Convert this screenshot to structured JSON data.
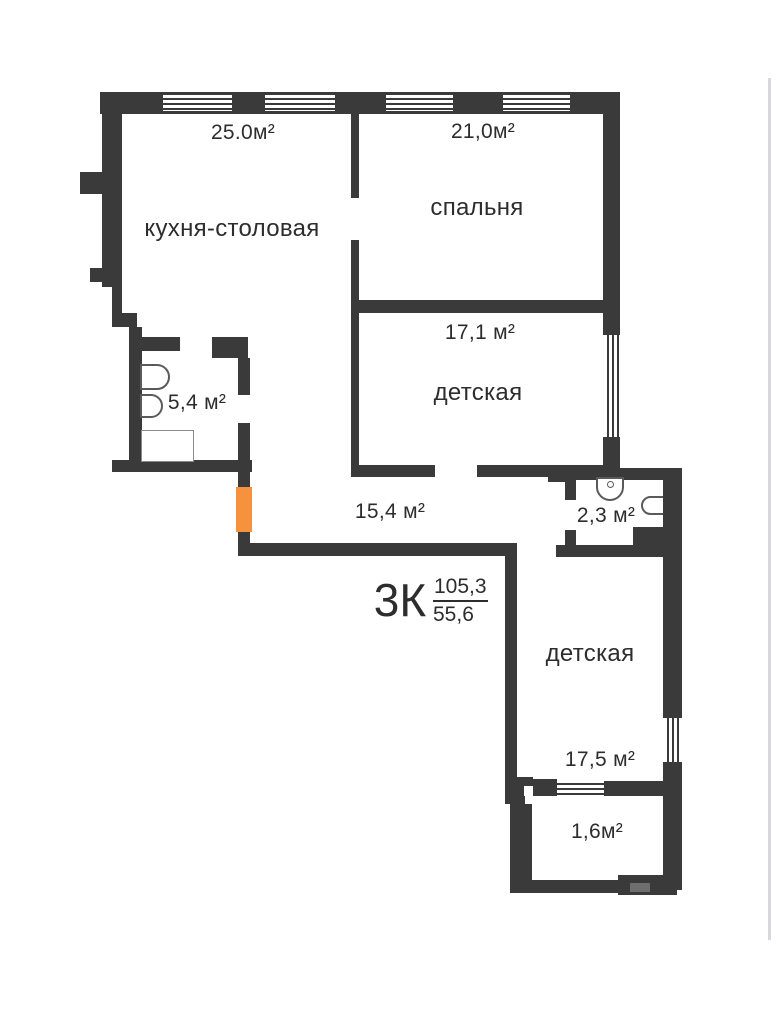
{
  "plan": {
    "type_label": "3К",
    "total_area": "105,3",
    "living_area": "55,6",
    "rooms": {
      "kitchen": {
        "name": "кухня-столовая",
        "area": "25.0м²"
      },
      "bedroom": {
        "name": "спальня",
        "area": "21,0м²"
      },
      "nursery1": {
        "name": "детская",
        "area": "17,1 м²"
      },
      "bath1": {
        "area": "5,4 м²"
      },
      "hallway": {
        "area": "15,4 м²"
      },
      "bath2": {
        "area": "2,3 м²"
      },
      "nursery2": {
        "name": "детская",
        "area": "17,5 м²"
      },
      "balcony": {
        "area": "1,6м²"
      }
    },
    "colors": {
      "wall": "#3A3A3A",
      "entrance_door_accent": "#F6923E",
      "background": "#FFFFFF",
      "text": "#2D2D2D"
    }
  }
}
